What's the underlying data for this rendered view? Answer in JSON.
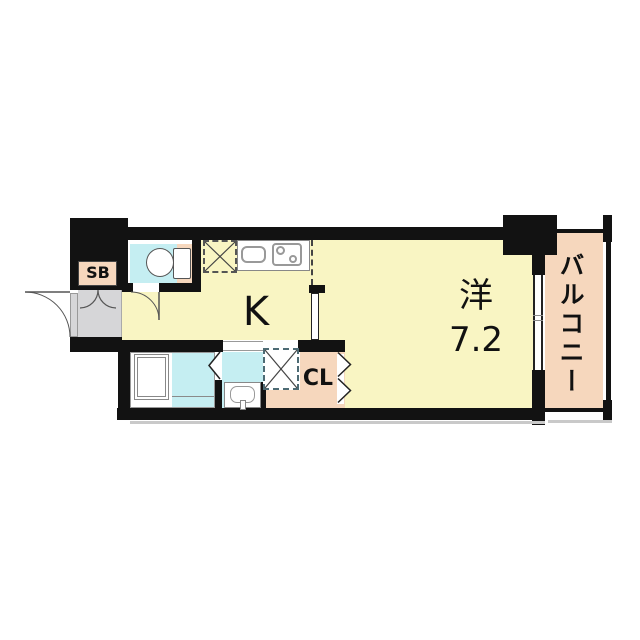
{
  "floorplan": {
    "title": "apartment-floor-plan",
    "labels": {
      "shoe_box": "SB",
      "kitchen": "K",
      "main_room_type": "洋",
      "main_room_size": "7.2",
      "closet": "CL",
      "balcony": "バルコニー"
    },
    "rooms": [
      {
        "name": "kitchen",
        "label": "K"
      },
      {
        "name": "western-room",
        "label": "洋 7.2"
      },
      {
        "name": "balcony",
        "label": "バルコニー"
      },
      {
        "name": "closet",
        "label": "CL"
      },
      {
        "name": "shoe-box",
        "label": "SB"
      },
      {
        "name": "toilet",
        "label": ""
      },
      {
        "name": "bathroom",
        "label": ""
      },
      {
        "name": "washroom",
        "label": ""
      },
      {
        "name": "entrance",
        "label": ""
      }
    ],
    "fixtures": [
      "toilet-icon",
      "bathtub-icon",
      "kitchen-sink-icon",
      "stove-icon",
      "washbasin-icon",
      "refrigerator-space-x-icon",
      "washer-space-x-icon",
      "entrance-door-arc-icon",
      "shoe-box-door-arcs-icon",
      "toilet-door-arc-icon",
      "folding-door-chevron-icon",
      "sliding-door-leaf-icon",
      "window-icon"
    ],
    "colors": {
      "room_yellow": "#f9f5c3",
      "wet_area_cyan": "#c5eef2",
      "balcony_peach": "#f6d7bd",
      "entry_gray": "#d6d6d8",
      "wall_black": "#121212",
      "fixture_white": "#ffffff",
      "outline_gray": "#8a8a8a"
    }
  }
}
